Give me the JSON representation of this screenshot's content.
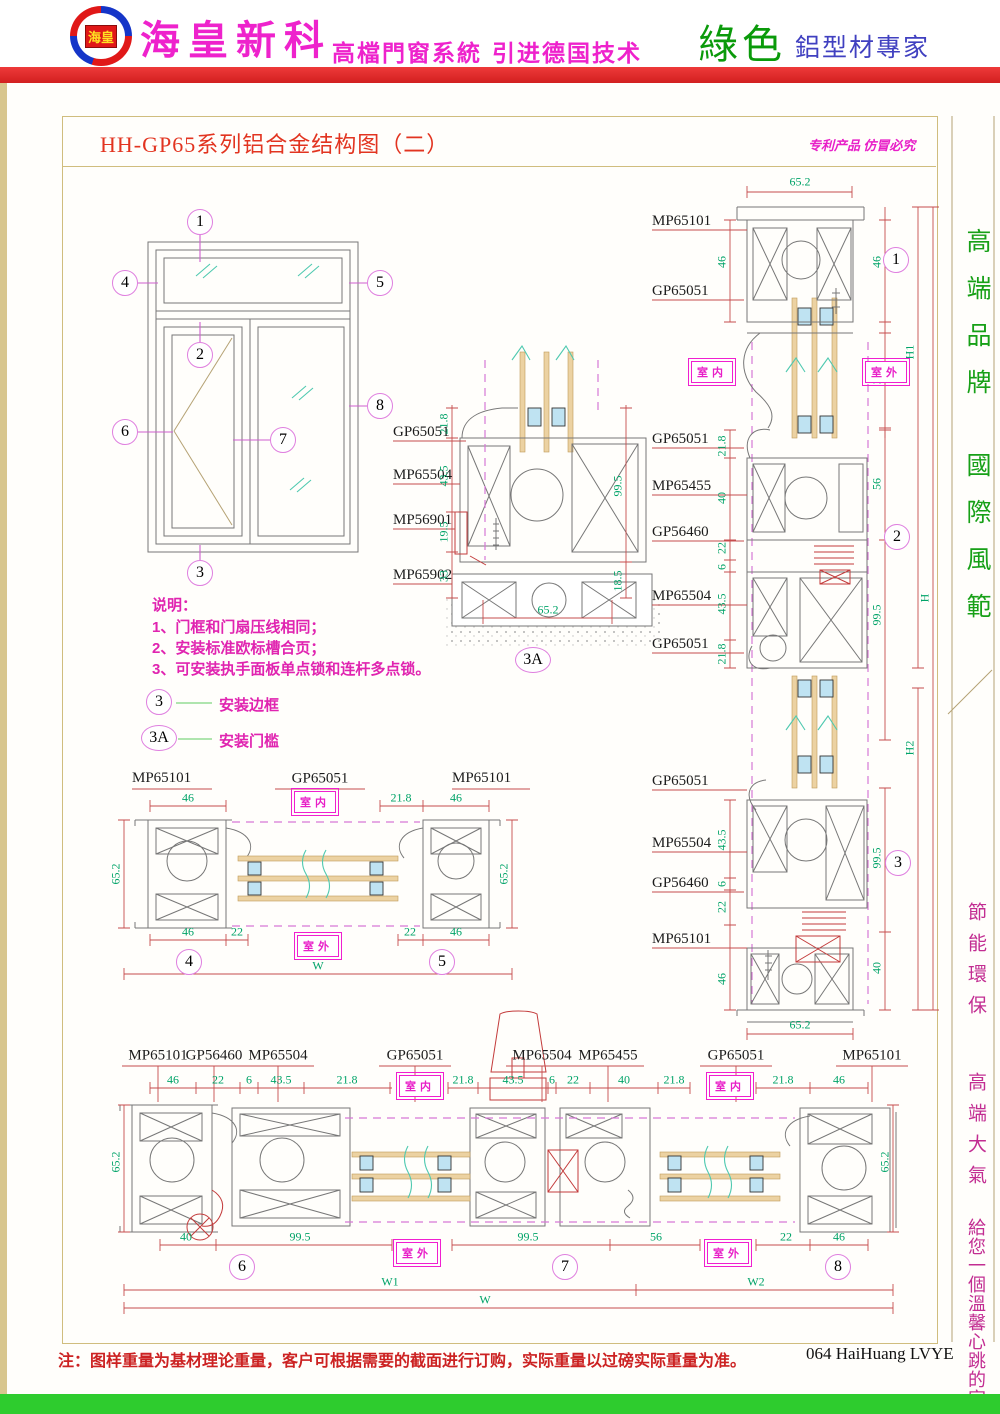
{
  "header": {
    "logo_text": "海皇",
    "company": "海皇新科",
    "tagline1": "高檔門窗系統",
    "tagline2": "引进德国技术",
    "green_label": "綠色",
    "expert_label": "鋁型材專家"
  },
  "titlebar": {
    "title": "HH-GP65系列铝合金结构图（二）",
    "patent_notice": "专利产品 仿冒必究"
  },
  "sidebar": {
    "green_1": "高端品牌",
    "green_2": "國際風範",
    "magenta_1": "節能環保",
    "magenta_2": "高端大氣",
    "magenta_3": "給您一個溫馨心跳的家"
  },
  "env": {
    "indoor": "室内",
    "outdoor": "室外"
  },
  "notes": {
    "heading": "说明：",
    "item1": "1、门框和门扇压线相同；",
    "item2": "2、安装标准欧标槽合页；",
    "item3": "3、可安装执手面板单点锁和连杆多点锁。",
    "legend1_mark": "3",
    "legend1_label": "安装边框",
    "legend2_mark": "3A",
    "legend2_label": "安装门槛"
  },
  "elevation": {
    "c1": "1",
    "c2": "2",
    "c3": "3",
    "c4": "4",
    "c5": "5",
    "c6": "6",
    "c7": "7",
    "c8": "8"
  },
  "s3a": {
    "callout": "3A",
    "p1": "GP65051",
    "d1": "21.8",
    "p2": "MP65504",
    "d2": "43.5",
    "p3": "MP56901",
    "d3": "19.5",
    "p4": "MP65902",
    "d4": "33",
    "dr1": "99.5",
    "dr2": "18.5",
    "db": "65.2"
  },
  "rt": {
    "callout": "1",
    "dt": "65.2",
    "p1": "MP65101",
    "p2": "GP65051",
    "dl1": "46",
    "dr1": "46",
    "dr2": "22",
    "h": "H1"
  },
  "rm": {
    "callout": "2",
    "p1": "GP65051",
    "d1": "21.8",
    "p2": "MP65455",
    "d2": "40",
    "p3": "GP56460",
    "d3": "22",
    "d3b": "6",
    "p4": "MP65504",
    "d4": "43.5",
    "p5": "GP65051",
    "d5": "21.8",
    "dr1": "56",
    "dr2": "99.5",
    "h": "H"
  },
  "rb": {
    "callout": "3",
    "p1": "GP65051",
    "p2": "MP65504",
    "d2": "43.5",
    "d2b": "6",
    "p3": "GP56460",
    "d3": "22",
    "p4": "MP65101",
    "d4": "46",
    "dr1": "99.5",
    "dr2": "40",
    "h": "H2",
    "db": "65.2"
  },
  "mh": {
    "c4": "4",
    "c5": "5",
    "pl": "MP65101",
    "pc": "GP65051",
    "pr": "MP65101",
    "dtl": "46",
    "dtc": "21.8",
    "dtr": "46",
    "dsl": "65.2",
    "dsr": "65.2",
    "dbl1": "46",
    "dbl2": "22",
    "dbr1": "22",
    "dbr2": "46",
    "w": "W"
  },
  "bh": {
    "c6": "6",
    "c7": "7",
    "c8": "8",
    "labels": [
      "MP65101",
      "GP56460",
      "MP65504",
      "GP65051",
      "MP65504",
      "MP65455",
      "GP65051",
      "MP65101"
    ],
    "top_dims": [
      "46",
      "22",
      "6",
      "43.5",
      "21.8",
      "21.8",
      "43.5",
      "6",
      "22",
      "40",
      "21.8",
      "21.8",
      "46"
    ],
    "dsl": "65.2",
    "dsr": "65.2",
    "bottom_dims": [
      "40",
      "99.5",
      "99.5",
      "56",
      "22",
      "46"
    ],
    "w1": "W1",
    "w2": "W2",
    "w": "W"
  },
  "footer": {
    "note": "注：图样重量为基材理论重量，客户可根据需要的截面进行订购，实际重量以过磅实际重量为准。",
    "page": "064 HaiHuang LVYE"
  }
}
